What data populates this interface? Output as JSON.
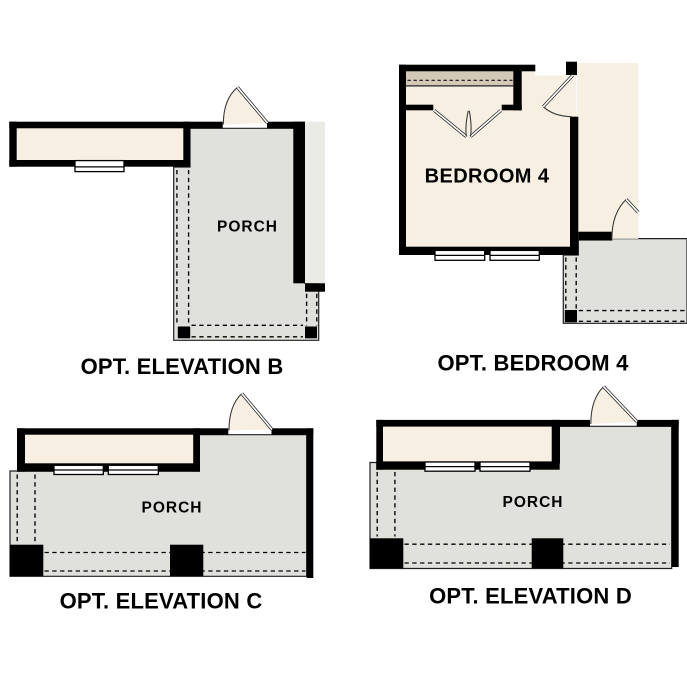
{
  "diagram": {
    "type": "floor-plan-options",
    "background": "#ffffff",
    "colors": {
      "wall": "#000000",
      "interior_beige": "#f7efe2",
      "porch_slab_gray": "#e0e0dd",
      "adjacent_slab_gray": "#eaeae7",
      "closet_shelf_tan": "#d3c9b6",
      "line": "#1f1f1f",
      "window_fill": "#ffffff"
    },
    "plans": {
      "elevation_b": {
        "caption": "OPT. ELEVATION B",
        "room_label": "PORCH"
      },
      "bedroom_4": {
        "caption": "OPT. BEDROOM 4",
        "room_label": "BEDROOM 4"
      },
      "elevation_c": {
        "caption": "OPT. ELEVATION C",
        "room_label": "PORCH"
      },
      "elevation_d": {
        "caption": "OPT. ELEVATION D",
        "room_label": "PORCH"
      }
    }
  }
}
